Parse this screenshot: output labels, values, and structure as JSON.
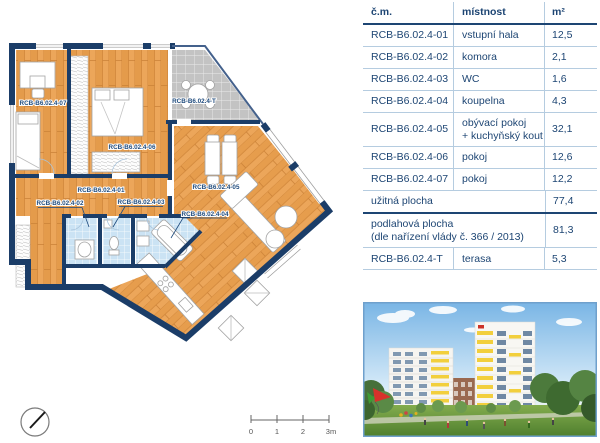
{
  "plan": {
    "labels": [
      {
        "id": "room-07",
        "text": "RCB-B6.02.4-07"
      },
      {
        "id": "room-06",
        "text": "RCB-B6.02.4-06"
      },
      {
        "id": "terrace",
        "text": "RCB-B6.02.4-T"
      },
      {
        "id": "hall-01",
        "text": "RCB-B6.02.4-01"
      },
      {
        "id": "room-02",
        "text": "RCB-B6.02.4-02"
      },
      {
        "id": "room-03",
        "text": "RCB-B6.02.4-03"
      },
      {
        "id": "room-05",
        "text": "RCB-B6.02.4-05"
      },
      {
        "id": "room-04",
        "text": "RCB-B6.02.4-04"
      }
    ],
    "colors": {
      "wall": "#1B3D68",
      "wood": "#ECA65A",
      "wet_tile": "#CBE3F4",
      "terrace_tile": "#C3C3C3",
      "label": "#1E4A7C"
    }
  },
  "table": {
    "headers": {
      "code": "č.m.",
      "room": "místnost",
      "area": "m²"
    },
    "rows": [
      {
        "code": "RCB-B6.02.4-01",
        "room": "vstupní hala",
        "area": "12,5"
      },
      {
        "code": "RCB-B6.02.4-02",
        "room": "komora",
        "area": "2,1"
      },
      {
        "code": "RCB-B6.02.4-03",
        "room": "WC",
        "area": "1,6"
      },
      {
        "code": "RCB-B6.02.4-04",
        "room": "koupelna",
        "area": "4,3"
      },
      {
        "code": "RCB-B6.02.4-05",
        "room": "obývací pokoj",
        "room2": "+ kuchyňský kout",
        "area": "32,1"
      },
      {
        "code": "RCB-B6.02.4-06",
        "room": "pokoj",
        "area": "12,6"
      },
      {
        "code": "RCB-B6.02.4-07",
        "room": "pokoj",
        "area": "12,2"
      }
    ],
    "summary_rows": [
      {
        "label": "užitná plocha",
        "area": "77,4"
      },
      {
        "label": "podlahová plocha",
        "label2": "(dle nařízení vlády č. 366 / 2013)",
        "area": "81,3"
      }
    ],
    "terrace_row": {
      "code": "RCB-B6.02.4-T",
      "room": "terasa",
      "area": "5,3"
    },
    "text_color": "#1D4573"
  },
  "scale_bar": {
    "tick_labels": [
      "0",
      "1",
      "2",
      "3m"
    ]
  },
  "photo": {
    "accent_colors": {
      "facade_yellow": "#F2CF3C",
      "sky": "#79B5E5",
      "lawn": "#6FA03F",
      "brick": "#9A6950"
    }
  }
}
